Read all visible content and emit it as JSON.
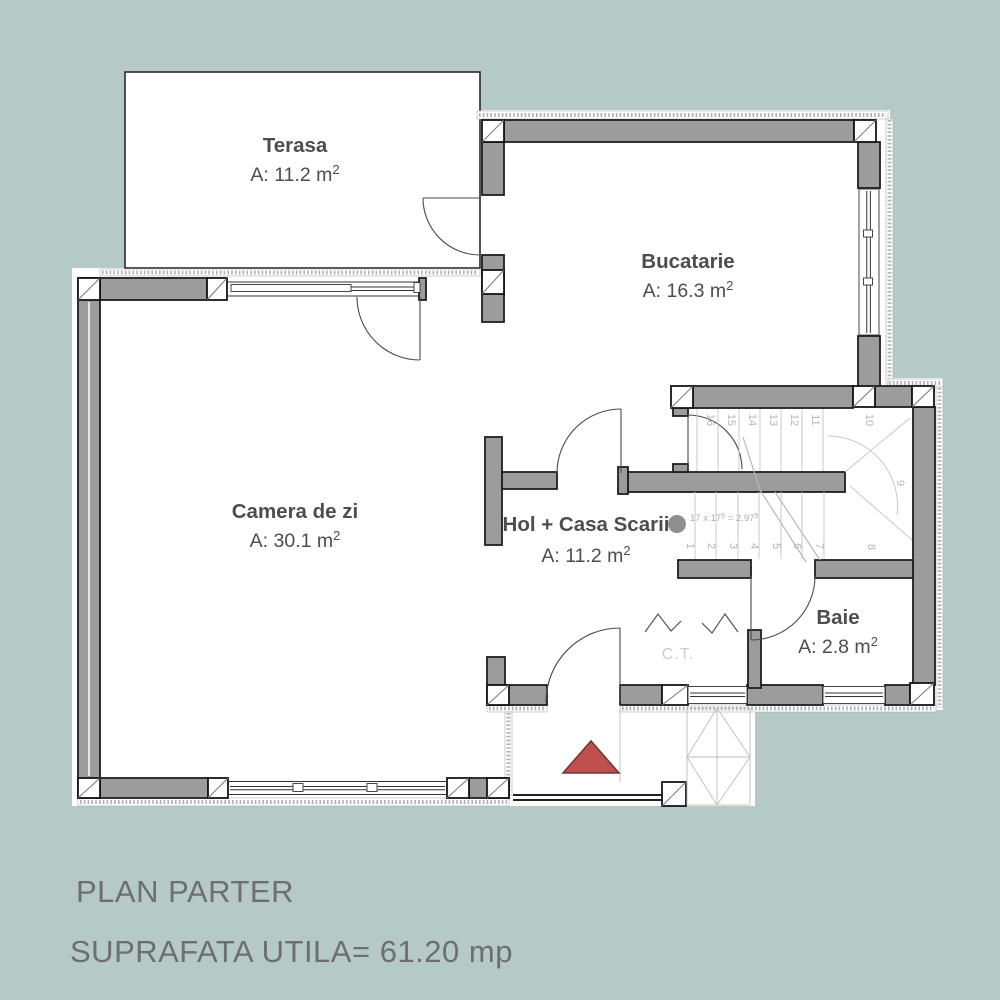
{
  "titles": {
    "line1": "PLAN PARTER",
    "line2": "SUPRAFATA UTILA= 61.20 mp"
  },
  "rooms": {
    "terasa": {
      "name": "Terasa",
      "area": "A: 11.2 m",
      "sup": "2"
    },
    "bucatarie": {
      "name": "Bucatarie",
      "area": "A: 16.3 m",
      "sup": "2"
    },
    "camera": {
      "name": "Camera de zi",
      "area": "A: 30.1 m",
      "sup": "2"
    },
    "hol": {
      "name": "Hol + Casa Scarii",
      "area": "A: 11.2 m",
      "sup": "2"
    },
    "baie": {
      "name": "Baie",
      "area": "A: 2.8 m",
      "sup": "2"
    },
    "ct": {
      "name": "C.T."
    }
  },
  "stairs": {
    "numbers": [
      "1",
      "2",
      "3",
      "4",
      "5",
      "6",
      "7",
      "8",
      "9",
      "10",
      "11",
      "12",
      "13",
      "14",
      "15",
      "16"
    ],
    "formula": {
      "base": "17 x 17",
      "sup1": "5",
      "mid": " = 2.97",
      "sup2": "5"
    }
  },
  "colors": {
    "background": "#b5cac6",
    "wall": "#9c9c9c",
    "outline": "#1f1f1f",
    "entrance_triangle": "#c0504d",
    "entrance_triangle_stroke": "#713833",
    "label": "#4d4d4d",
    "stair_lines": "#c8c8c8",
    "muted_text": "#b5b5b5",
    "title_text": "#6e6e6e"
  }
}
